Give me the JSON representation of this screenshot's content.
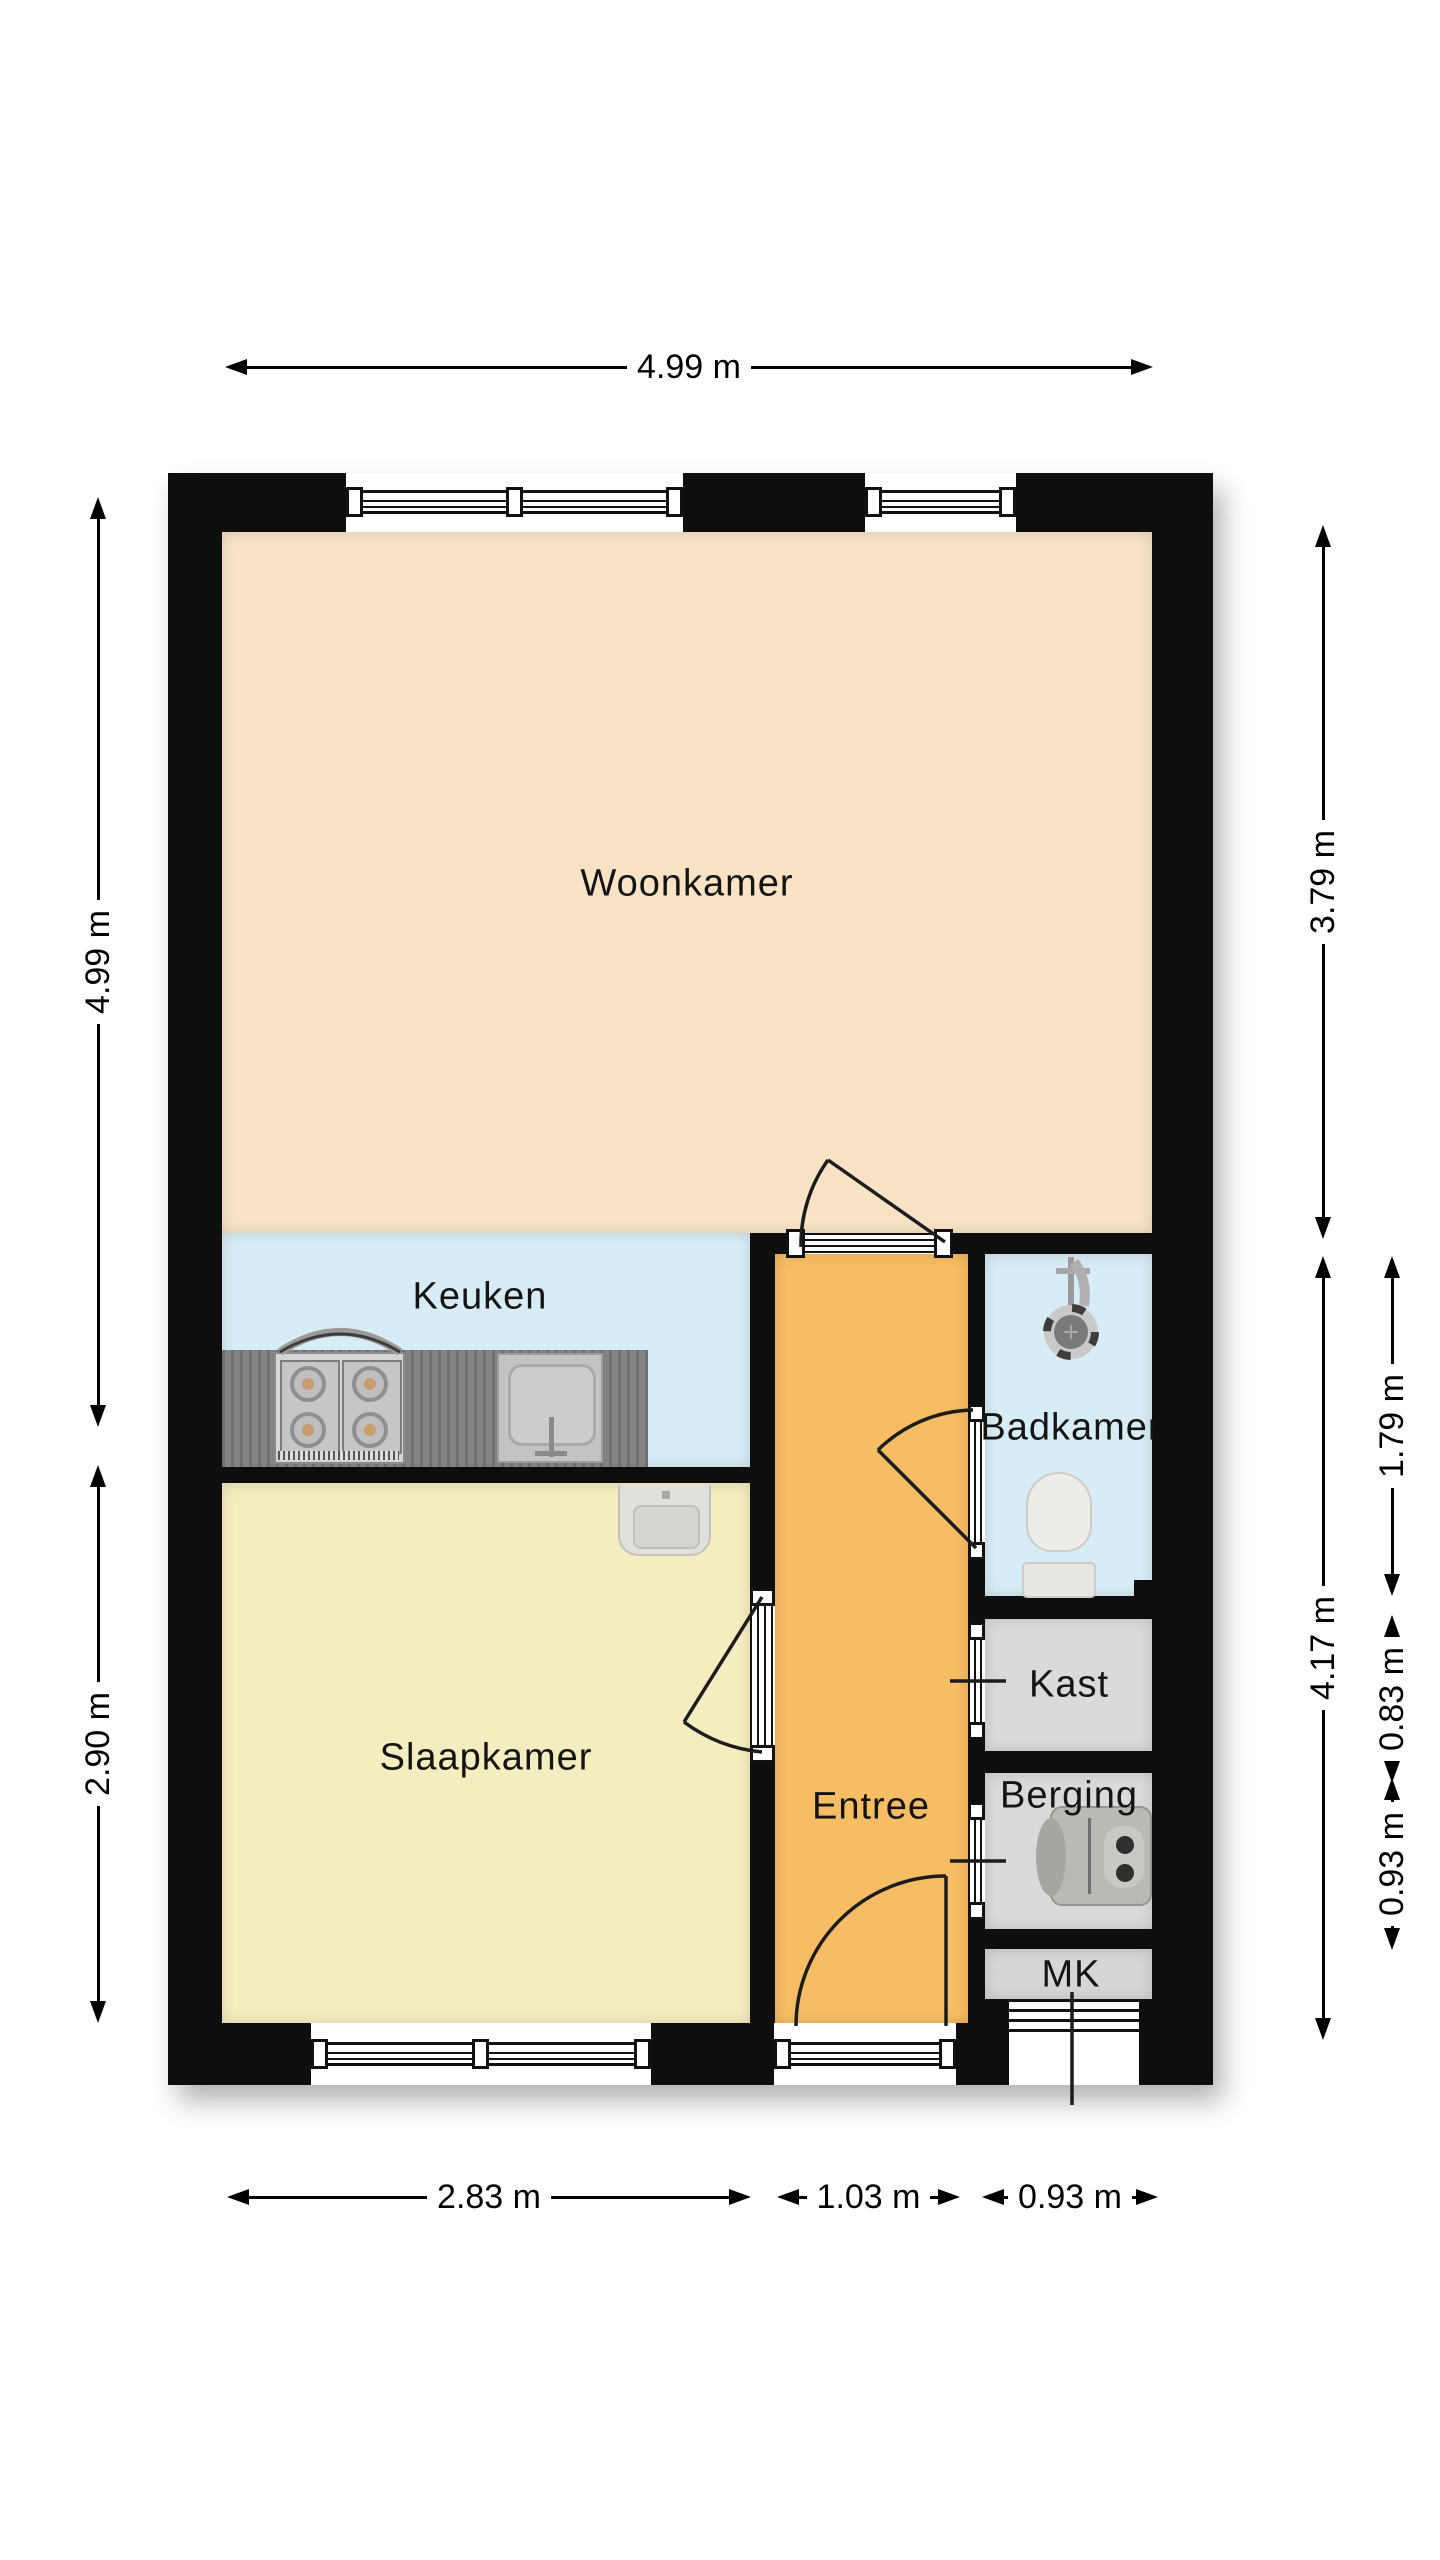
{
  "rooms": {
    "woonkamer": {
      "label": "Woonkamer",
      "floor_color": "#f8e3c5"
    },
    "keuken": {
      "label": "Keuken",
      "floor_color": "#d8ecf5"
    },
    "slaapkamer": {
      "label": "Slaapkamer",
      "floor_color": "#f4edbf"
    },
    "entree": {
      "label": "Entree",
      "floor_color": "#f6bd64"
    },
    "badkamer": {
      "label": "Badkamer",
      "floor_color": "#d8ecf5"
    },
    "kast": {
      "label": "Kast",
      "floor_color": "#dadada"
    },
    "berging": {
      "label": "Berging",
      "floor_color": "#dadada"
    },
    "mk": {
      "label": "MK",
      "floor_color": "#d6d6d6"
    }
  },
  "dimensions": {
    "top_width": {
      "label": "4.99 m"
    },
    "left_upper": {
      "label": "4.99 m"
    },
    "left_lower": {
      "label": "2.90 m"
    },
    "right_woonkamer": {
      "label": "3.79 m"
    },
    "right_lower_total": {
      "label": "4.17 m"
    },
    "right_badkamer": {
      "label": "1.79 m"
    },
    "right_kast": {
      "label": "0.83 m"
    },
    "right_berging": {
      "label": "0.93 m"
    },
    "bottom_slaapkamer": {
      "label": "2.83 m"
    },
    "bottom_entree": {
      "label": "1.03 m"
    },
    "bottom_right": {
      "label": "0.93 m"
    }
  },
  "colors": {
    "wall": "#0e0e0e",
    "counter": "#7b7b7b",
    "dimension_text": "#000000",
    "background": "#ffffff"
  },
  "fixtures": {
    "stove": "gas-stove-4-burners",
    "sink": "kitchen-sink",
    "shower": "shower-head",
    "toilet": "toilet",
    "washbasin": "washbasin",
    "boiler": "water-heater"
  }
}
